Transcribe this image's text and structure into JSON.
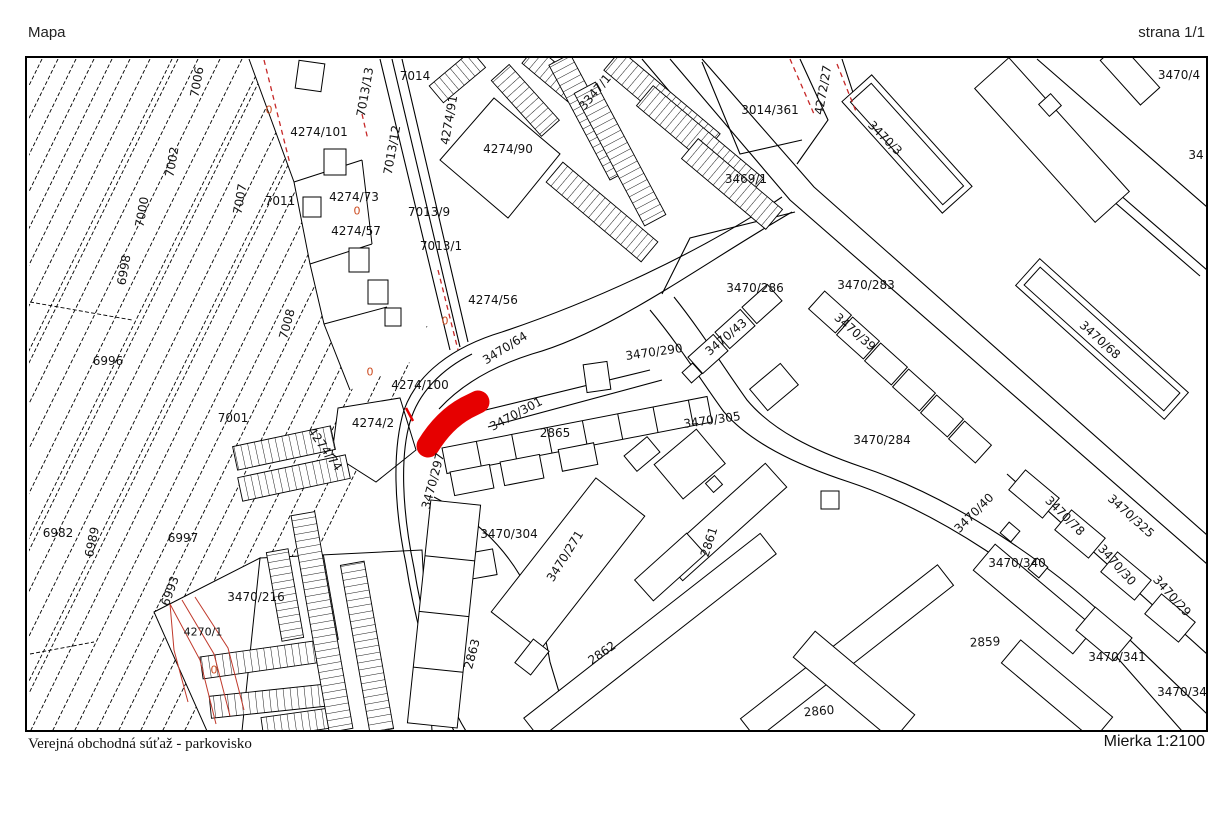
{
  "page": {
    "title": "Mapa",
    "page_indicator": "strana 1/1",
    "footer_left": "Verejná obchodná súťaž - parkovisko",
    "scale_label": "Mierka 1:2100"
  },
  "map": {
    "highlight_color": "#e60000",
    "line_color": "#000000",
    "survey_red": "#c0392b",
    "marker_color": "#cc4a1e",
    "labels": [
      {
        "t": "7006",
        "x": 195,
        "y": 80,
        "r": -80
      },
      {
        "t": "7002",
        "x": 170,
        "y": 160,
        "r": -80
      },
      {
        "t": "7000",
        "x": 140,
        "y": 210,
        "r": -80
      },
      {
        "t": "6998",
        "x": 122,
        "y": 268,
        "r": -80
      },
      {
        "t": "7007",
        "x": 238,
        "y": 197,
        "r": -80
      },
      {
        "t": "7011",
        "x": 278,
        "y": 199
      },
      {
        "t": "7008",
        "x": 285,
        "y": 322,
        "r": -75
      },
      {
        "t": "6996",
        "x": 106,
        "y": 359
      },
      {
        "t": "7001",
        "x": 231,
        "y": 416
      },
      {
        "t": "6982",
        "x": 56,
        "y": 531
      },
      {
        "t": "6989",
        "x": 90,
        "y": 540,
        "r": -78
      },
      {
        "t": "6993",
        "x": 168,
        "y": 589,
        "r": -70
      },
      {
        "t": "6997",
        "x": 181,
        "y": 536
      },
      {
        "t": "6976",
        "x": 16,
        "y": 580,
        "r": -78
      },
      {
        "t": "3470/216",
        "x": 254,
        "y": 595
      },
      {
        "t": "4270/1",
        "x": 201,
        "y": 630,
        "s": 11
      },
      {
        "t": "4274/101",
        "x": 317,
        "y": 130
      },
      {
        "t": "7013/13",
        "x": 363,
        "y": 90,
        "r": -80
      },
      {
        "t": "7013/12",
        "x": 390,
        "y": 148,
        "r": -80
      },
      {
        "t": "7014",
        "x": 413,
        "y": 74
      },
      {
        "t": "4274/91",
        "x": 447,
        "y": 118,
        "r": -80
      },
      {
        "t": "4274/73",
        "x": 352,
        "y": 195
      },
      {
        "t": "4274/57",
        "x": 354,
        "y": 229
      },
      {
        "t": "7013/9",
        "x": 427,
        "y": 210
      },
      {
        "t": "7013/1",
        "x": 439,
        "y": 244
      },
      {
        "t": "4274/90",
        "x": 506,
        "y": 147
      },
      {
        "t": "4274/56",
        "x": 491,
        "y": 298
      },
      {
        "t": "3347/1",
        "x": 593,
        "y": 90,
        "r": -50
      },
      {
        "t": "3014/361",
        "x": 768,
        "y": 108
      },
      {
        "t": "4272/27",
        "x": 821,
        "y": 88,
        "r": -80
      },
      {
        "t": "3470/3",
        "x": 883,
        "y": 136,
        "r": 45
      },
      {
        "t": "3470/4",
        "x": 1177,
        "y": 73
      },
      {
        "t": "34",
        "x": 1194,
        "y": 153
      },
      {
        "t": "3469/1",
        "x": 744,
        "y": 177
      },
      {
        "t": "3470/286",
        "x": 753,
        "y": 286
      },
      {
        "t": "3470/283",
        "x": 864,
        "y": 283
      },
      {
        "t": "3470/43",
        "x": 724,
        "y": 335,
        "r": -40
      },
      {
        "t": "3470/39",
        "x": 853,
        "y": 330,
        "r": 41
      },
      {
        "t": "3470/68",
        "x": 1098,
        "y": 338,
        "r": 42
      },
      {
        "t": "3470/64",
        "x": 503,
        "y": 346,
        "r": -32
      },
      {
        "t": "3470/290",
        "x": 652,
        "y": 350,
        "r": -8
      },
      {
        "t": "4274/100",
        "x": 418,
        "y": 383
      },
      {
        "t": "4274/2",
        "x": 371,
        "y": 421
      },
      {
        "t": "4274/74",
        "x": 323,
        "y": 447,
        "r": 55
      },
      {
        "t": "3470/301",
        "x": 514,
        "y": 412,
        "r": -28
      },
      {
        "t": "2865",
        "x": 553,
        "y": 431
      },
      {
        "t": "3470/305",
        "x": 710,
        "y": 418,
        "r": -8
      },
      {
        "t": "3470/284",
        "x": 880,
        "y": 438
      },
      {
        "t": "3470/297",
        "x": 431,
        "y": 479,
        "r": -75
      },
      {
        "t": "3470/304",
        "x": 507,
        "y": 532
      },
      {
        "t": "3470/271",
        "x": 563,
        "y": 554,
        "r": -58
      },
      {
        "t": "2863",
        "x": 470,
        "y": 652,
        "r": -75
      },
      {
        "t": "2862",
        "x": 600,
        "y": 651,
        "r": -35
      },
      {
        "t": "2861",
        "x": 707,
        "y": 540,
        "r": -72
      },
      {
        "t": "2859",
        "x": 983,
        "y": 640,
        "r": -3
      },
      {
        "t": "2860",
        "x": 817,
        "y": 709,
        "r": -5
      },
      {
        "t": "3470/40",
        "x": 972,
        "y": 511,
        "r": -45
      },
      {
        "t": "3470/78",
        "x": 1063,
        "y": 514,
        "r": 45
      },
      {
        "t": "3470/325",
        "x": 1129,
        "y": 514,
        "r": 42
      },
      {
        "t": "3470/30",
        "x": 1115,
        "y": 563,
        "r": 48
      },
      {
        "t": "3470/29",
        "x": 1170,
        "y": 594,
        "r": 48
      },
      {
        "t": "3470/340",
        "x": 1015,
        "y": 561
      },
      {
        "t": "3470/341",
        "x": 1115,
        "y": 655
      },
      {
        "t": "3470/34",
        "x": 1180,
        "y": 690
      }
    ],
    "markers": [
      {
        "t": "0",
        "x": 267,
        "y": 108,
        "c": "#cc4a1e",
        "s": 11
      },
      {
        "t": "0",
        "x": 355,
        "y": 209,
        "c": "#cc4a1e",
        "s": 11
      },
      {
        "t": "0",
        "x": 443,
        "y": 319,
        "c": "#cc4a1e",
        "s": 11
      },
      {
        "t": "0",
        "x": 368,
        "y": 370,
        "c": "#cc4a1e",
        "s": 11
      },
      {
        "t": "0",
        "x": 212,
        "y": 668,
        "c": "#cc4a1e",
        "s": 11
      }
    ]
  }
}
